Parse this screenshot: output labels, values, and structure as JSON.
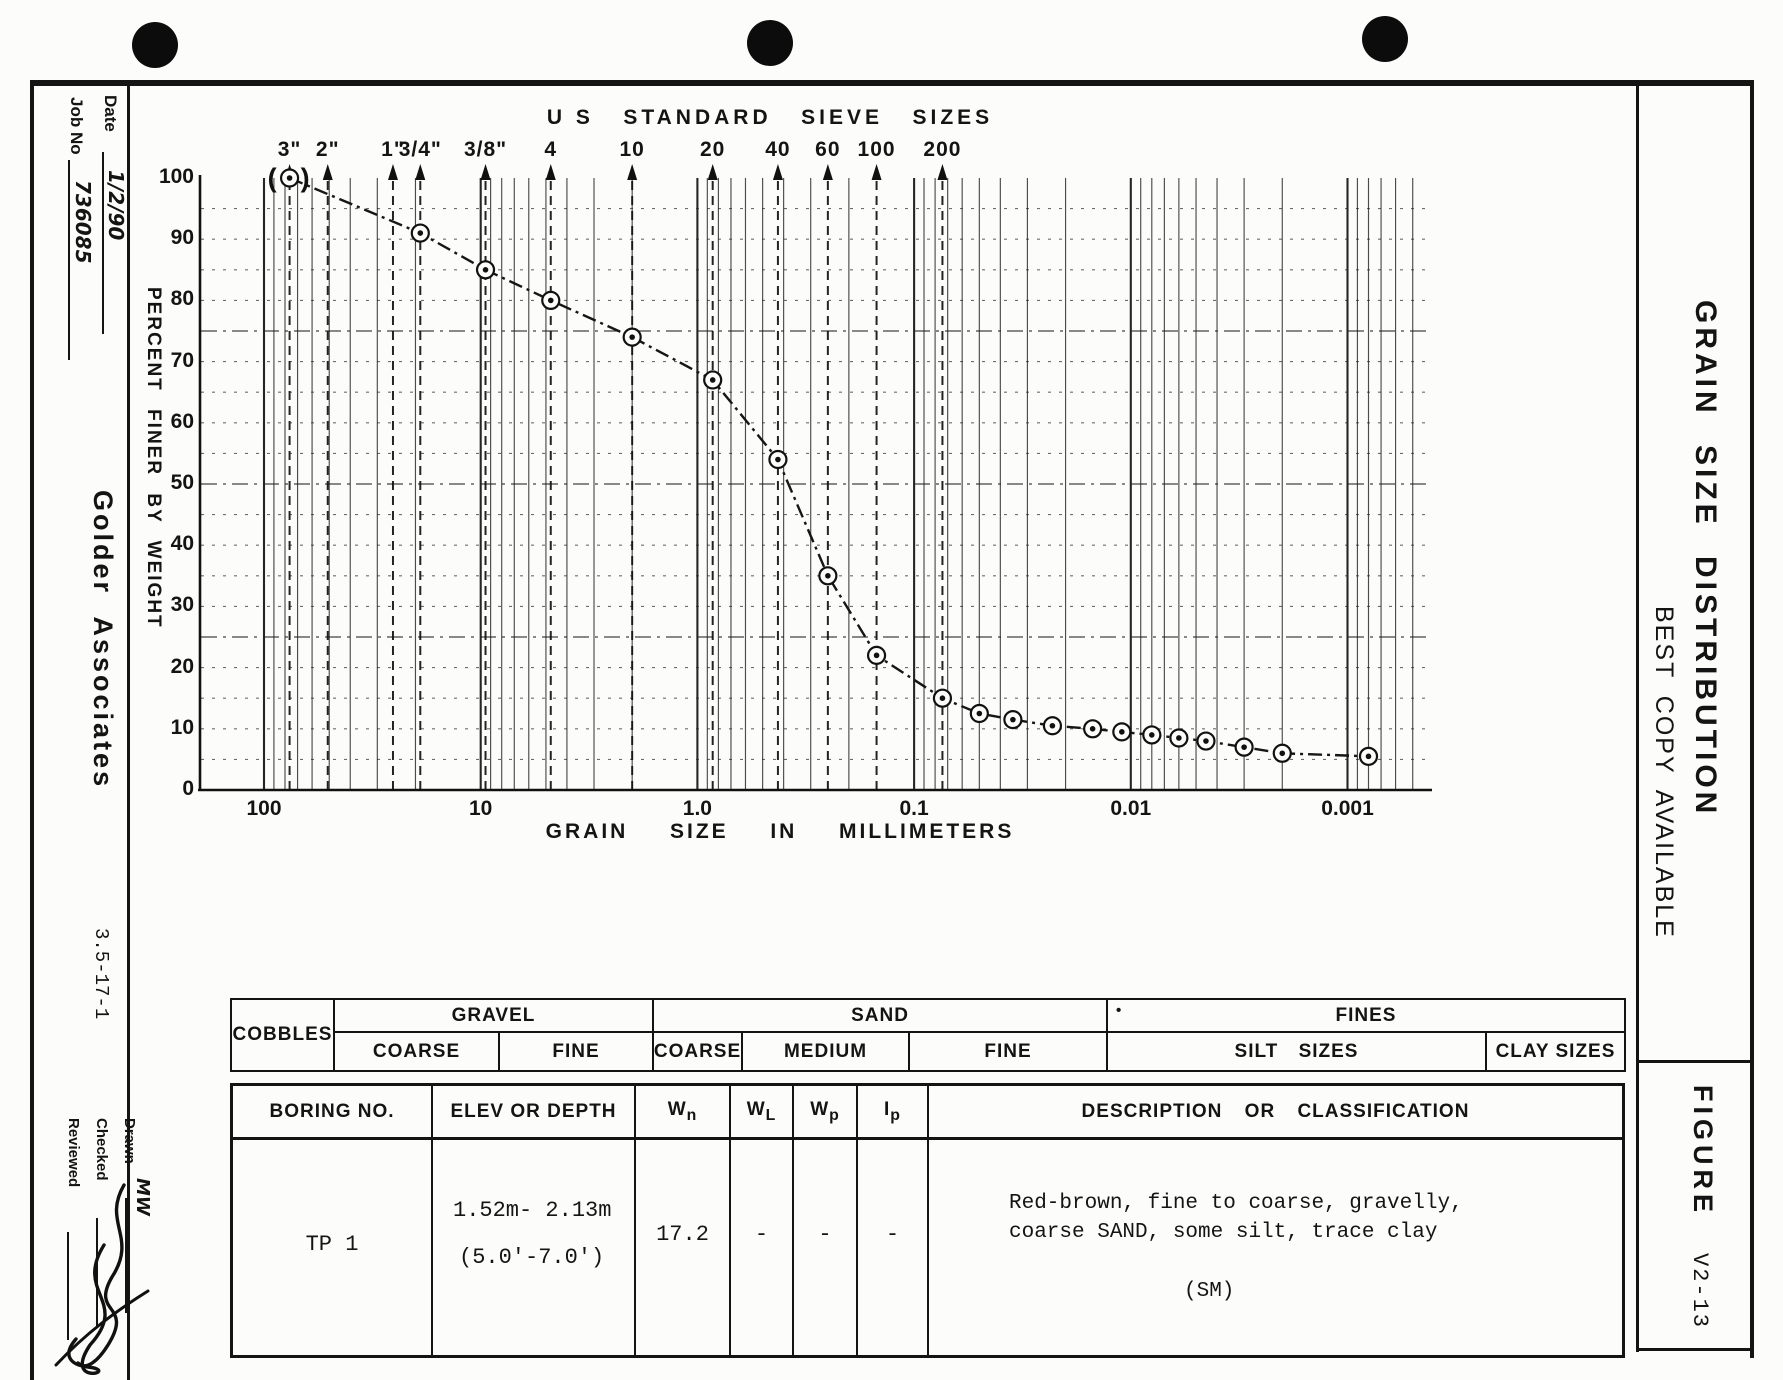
{
  "sidebar": {
    "date_label": "Date",
    "date_value": "1/2/90",
    "job_label": "Job No",
    "job_value": "736085",
    "company": "Golder Associates",
    "doc_number": "3.5-17-1",
    "drawn_label": "Drawn",
    "drawn_value": "MW",
    "checked_label": "Checked",
    "reviewed_label": "Reviewed"
  },
  "chart_data": {
    "type": "line",
    "top_title": "U S   STANDARD   SIEVE   SIZES",
    "xlabel": "GRAIN  SIZE  IN  MILLIMETERS",
    "ylabel": "PERCENT  FINER  BY  WEIGHT",
    "x_scale": "log",
    "x_unit": "mm",
    "xlim_mm": [
      200,
      0.0004
    ],
    "ylim": [
      0,
      100
    ],
    "y_tick_step": 10,
    "grid": true,
    "x_decade_labels": [
      {
        "label": "100",
        "mm": 100
      },
      {
        "label": "10",
        "mm": 10
      },
      {
        "label": "1.0",
        "mm": 1
      },
      {
        "label": "0.1",
        "mm": 0.1
      },
      {
        "label": "0.01",
        "mm": 0.01
      },
      {
        "label": "0.001",
        "mm": 0.001
      }
    ],
    "sieve_sizes": [
      {
        "label": "3\"",
        "mm": 76.2
      },
      {
        "label": "2\"",
        "mm": 50.8
      },
      {
        "label": "1\"",
        "mm": 25.4
      },
      {
        "label": "3/4\"",
        "mm": 19
      },
      {
        "label": "3/8\"",
        "mm": 9.5
      },
      {
        "label": "4",
        "mm": 4.75
      },
      {
        "label": "10",
        "mm": 2
      },
      {
        "label": "20",
        "mm": 0.85
      },
      {
        "label": "40",
        "mm": 0.425
      },
      {
        "label": "60",
        "mm": 0.25
      },
      {
        "label": "100",
        "mm": 0.149
      },
      {
        "label": "200",
        "mm": 0.074
      }
    ],
    "series": [
      {
        "name": "TP 1",
        "first_point_estimated": true,
        "points": [
          {
            "mm": 76.2,
            "percent_finer": 100
          },
          {
            "mm": 19,
            "percent_finer": 91
          },
          {
            "mm": 9.5,
            "percent_finer": 85
          },
          {
            "mm": 4.75,
            "percent_finer": 80
          },
          {
            "mm": 2.0,
            "percent_finer": 74
          },
          {
            "mm": 0.85,
            "percent_finer": 67
          },
          {
            "mm": 0.425,
            "percent_finer": 54
          },
          {
            "mm": 0.25,
            "percent_finer": 35
          },
          {
            "mm": 0.149,
            "percent_finer": 22
          },
          {
            "mm": 0.074,
            "percent_finer": 15
          },
          {
            "mm": 0.05,
            "percent_finer": 12.5
          },
          {
            "mm": 0.035,
            "percent_finer": 11.5
          },
          {
            "mm": 0.023,
            "percent_finer": 10.5
          },
          {
            "mm": 0.015,
            "percent_finer": 10
          },
          {
            "mm": 0.011,
            "percent_finer": 9.5
          },
          {
            "mm": 0.008,
            "percent_finer": 9
          },
          {
            "mm": 0.006,
            "percent_finer": 8.5
          },
          {
            "mm": 0.0045,
            "percent_finer": 8
          },
          {
            "mm": 0.003,
            "percent_finer": 7
          },
          {
            "mm": 0.002,
            "percent_finer": 6
          },
          {
            "mm": 0.0008,
            "percent_finer": 5.5
          }
        ]
      }
    ]
  },
  "classification_bar": {
    "cobbles": "COBBLES",
    "gravel": {
      "label": "GRAVEL",
      "coarse": "COARSE",
      "fine": "FINE"
    },
    "sand": {
      "label": "SAND",
      "coarse": "COARSE",
      "medium": "MEDIUM",
      "fine": "FINE"
    },
    "fines": {
      "label": "FINES",
      "tick": "•",
      "silt": "SILT SIZES",
      "clay": "CLAY SIZES"
    }
  },
  "sample_table": {
    "headers": {
      "boring": "BORING NO.",
      "elev": "ELEV OR DEPTH",
      "wn_base": "W",
      "wn_sub": "n",
      "wl_base": "W",
      "wl_sub": "L",
      "wp_base": "W",
      "wp_sub": "p",
      "ip_base": "I",
      "ip_sub": "p",
      "desc": "DESCRIPTION OR CLASSIFICATION"
    },
    "row": {
      "boring": "TP 1",
      "depth_metric": "1.52m- 2.13m",
      "depth_imperial": "(5.0'-7.0')",
      "wn": "17.2",
      "wl": "-",
      "wp": "-",
      "ip": "-",
      "description_line1": "Red-brown, fine to coarse, gravelly,",
      "description_line2": "coarse SAND, some silt, trace clay",
      "classification": "(SM)"
    }
  },
  "right_panel": {
    "title": "GRAIN  SIZE  DISTRIBUTION",
    "stamp": "BEST COPY AVAILABLE",
    "figure_label": "FIGURE",
    "figure_number": "V2-13"
  }
}
